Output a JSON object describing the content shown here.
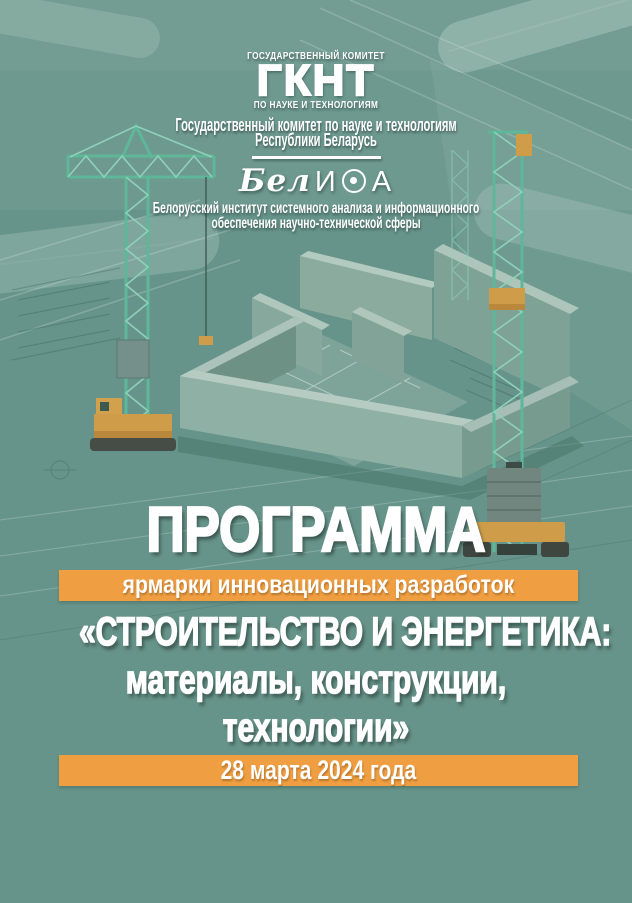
{
  "page": {
    "background_color": "#67948a",
    "accent_orange": "#f09e42",
    "text_color": "#ffffff"
  },
  "header": {
    "gknt_logo": {
      "top_line": "ГОСУДАРСТВЕННЫЙ КОМИТЕТ",
      "acronym": "ГКНТ",
      "bottom_line": "ПО НАУКЕ И ТЕХНОЛОГИЯМ"
    },
    "committee_line1": "Государственный комитет по науке и технологиям",
    "committee_line2": "Республики Беларусь",
    "belisa_logo": {
      "full_name": "БелИСА",
      "script_part": "Бел",
      "letter_i": "И",
      "letter_a": "А"
    },
    "belisa_line1": "Белорусский институт системного анализа и информационного",
    "belisa_line2": "обеспечения научно-технической сферы"
  },
  "main": {
    "program_title": "ПРОГРАММА",
    "subtitle_banner": "ярмарки инновационных разработок",
    "event_title_line1": "«СТРОИТЕЛЬСТВО И ЭНЕРГЕТИКА:",
    "event_title_line2": "материалы, конструкции,",
    "event_title_line3": "технологии»",
    "date_banner": "28 марта 2024 года"
  }
}
